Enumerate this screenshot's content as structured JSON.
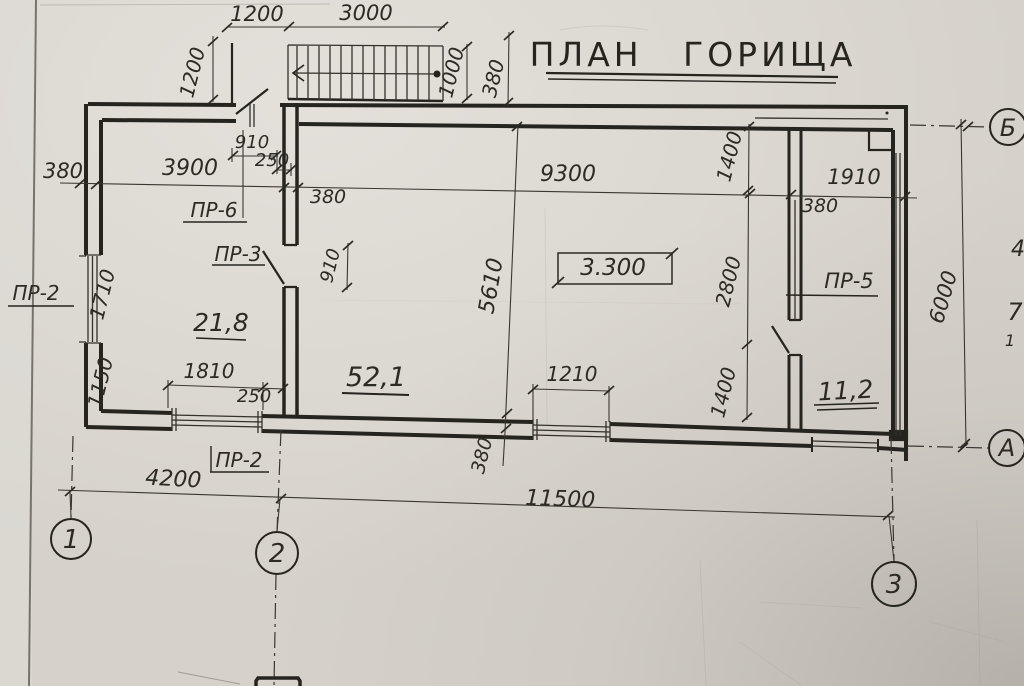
{
  "title": {
    "text": "ПЛАН ГОРИЩА"
  },
  "dimensions": {
    "top_landing": "1200",
    "top_stairs": "3000",
    "landing_depth": "1200",
    "stairs_width": "1000",
    "stair_wall": "380",
    "left_wall": "380",
    "room_small_width": "3900",
    "door6_width": "910",
    "door6_offset": "250",
    "partition_thickness": "380",
    "hall_width": "9300",
    "right_window": "1910",
    "right_wall": "380",
    "door3_opening": "910",
    "left_upper": "1710",
    "left_lower": "1150",
    "hall_depth": "5610",
    "seg_top": "1400",
    "seg_mid": "2800",
    "seg_bottom": "1400",
    "window1_width": "1810",
    "window1_offset": "250",
    "window2_width": "1210",
    "bottom_wall": "380",
    "axis_1_2": "4200",
    "axis_1_3": "11500",
    "axis_a_b": "6000"
  },
  "elevation_mark": "3.300",
  "openings": {
    "pr2_left": "ПР-2",
    "pr6": "ПР-6",
    "pr3": "ПР-3",
    "pr5": "ПР-5",
    "pr2_bottom": "ПР-2"
  },
  "rooms": {
    "room_small": "21,8",
    "room_large": "52,1",
    "room_right": "11,2"
  },
  "axes": {
    "v1": "1",
    "v2": "2",
    "v3": "3",
    "hA": "А",
    "hB": "Б"
  },
  "edge_marks": {
    "m1": "4",
    "m2": "7",
    "m3": "1"
  },
  "colors": {
    "paper": "#d6d2cb",
    "ink": "#26241f"
  }
}
